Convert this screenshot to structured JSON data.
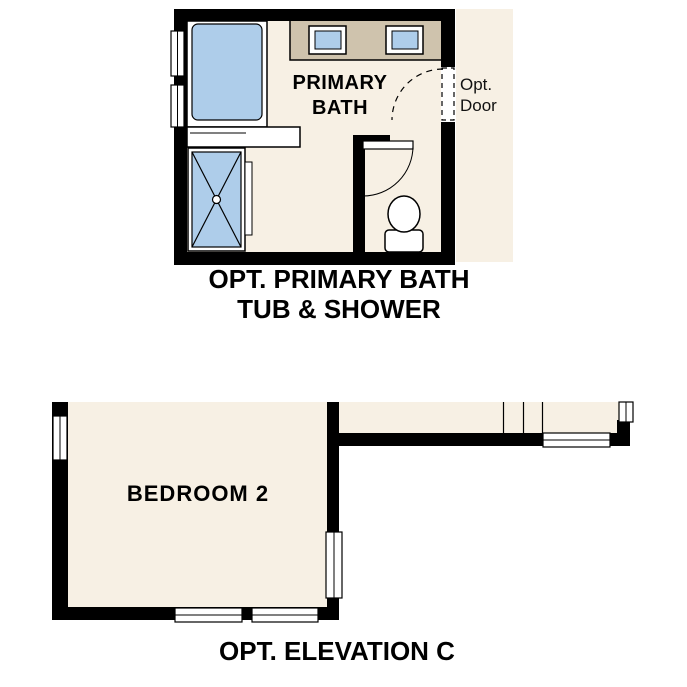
{
  "colors": {
    "background": "#ffffff",
    "floor": "#f7f0e4",
    "fixture_blue": "#aecdea",
    "counter_tan": "#cfc3ad",
    "wall": "#000000"
  },
  "primary_bath": {
    "room_label": {
      "line1": "PRIMARY",
      "line2": "BATH"
    },
    "opt_door_label": {
      "line1": "Opt.",
      "line2": "Door"
    },
    "caption": {
      "line1": "OPT. PRIMARY BATH",
      "line2": "TUB & SHOWER"
    },
    "fixtures": [
      "bathtub",
      "shower",
      "vanity-with-two-sinks",
      "toilet",
      "interior-door",
      "optional-door",
      "windows"
    ]
  },
  "elevation": {
    "room_label": "BEDROOM 2",
    "caption": "OPT. ELEVATION C",
    "features": [
      "bedroom-2",
      "adjacent-room",
      "windows"
    ]
  }
}
